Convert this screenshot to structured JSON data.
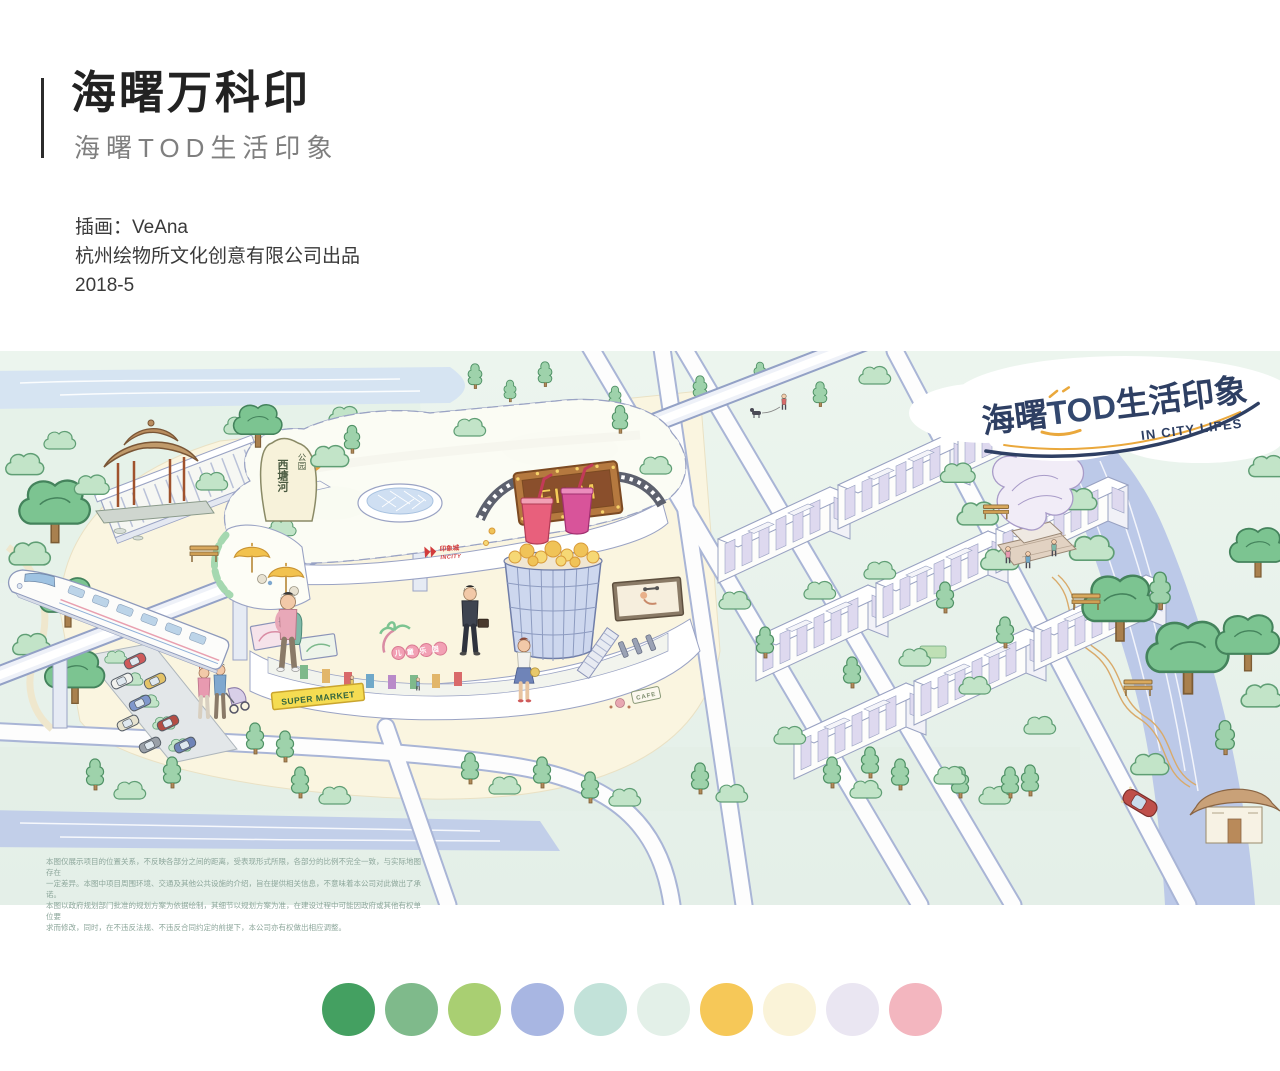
{
  "header": {
    "title": "海曙万科印",
    "subtitle": "海曙TOD生活印象",
    "credits": {
      "illustrator": "插画：VeAna",
      "studio": "杭州绘物所文化创意有限公司出品",
      "date": "2018-5"
    }
  },
  "illustration": {
    "cloud_logo": {
      "zh_pre": "海曙",
      "zh_tod": "TOD",
      "zh_post": "生活印象",
      "en": "IN CITY LIFES"
    },
    "signs": {
      "cinema": "FILM",
      "supermarket": "SUPER MARKET",
      "mall_zh": "印象城",
      "mall_en": "INCITY",
      "kids_zone": "儿童乐园",
      "park_name": "西塘河",
      "park_suffix": "公园",
      "cafe": "CAFE"
    },
    "disclaimer": {
      "line1": "本图仅展示项目的位置关系，不反映各部分之间的距离，受表现形式所限，各部分的比例不完全一致，与实际地图存在",
      "line2": "一定差异。本图中项目周围环境、交通及其他公共设施的介绍，旨在提供相关信息，不意味着本公司对此做出了承诺。",
      "line3": "本图以政府规划部门批准的规划方案为依据绘制，其细节以规划方案为准，在建设过程中可能因政府或其他有权单位要",
      "line4": "求而修改，同时，在不违反法规、不违反合同约定的前提下，本公司亦有权做出相应调整。"
    }
  },
  "palette": {
    "colors": [
      "#44a061",
      "#7fba8b",
      "#a9cf72",
      "#a8b6e2",
      "#c2e2d9",
      "#e3f0e8",
      "#f6c858",
      "#faf3d8",
      "#eae6f2",
      "#f3b6bf"
    ]
  }
}
